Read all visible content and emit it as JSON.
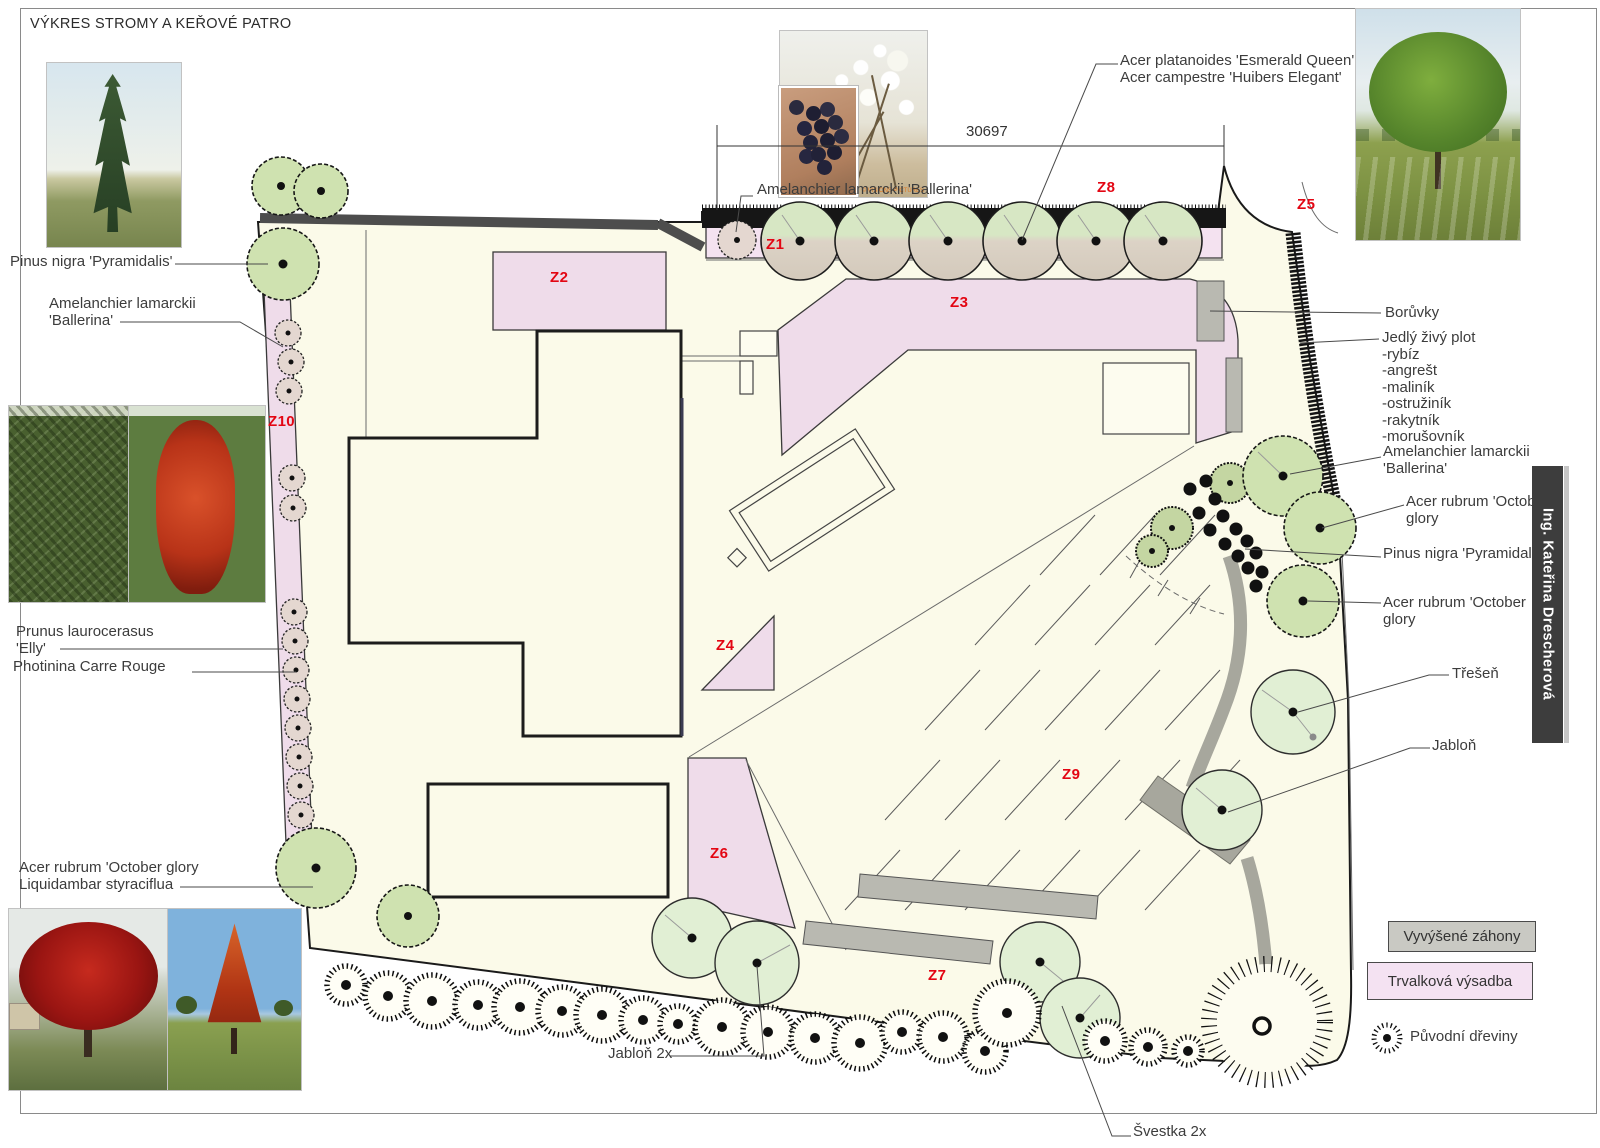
{
  "title": "VÝKRES STROMY A KEŘOVÉ PATRO",
  "author_bar": "Ing. Kateřina Drescherová",
  "dimension": {
    "value": "30697"
  },
  "zones": {
    "z1": "Z1",
    "z2": "Z2",
    "z3": "Z3",
    "z4": "Z4",
    "z5": "Z5",
    "z6": "Z6",
    "z7": "Z7",
    "z8": "Z8",
    "z9": "Z9",
    "z10": "Z10"
  },
  "labels": {
    "pinus_left": "Pinus nigra 'Pyramidalis'",
    "amelanchier_left": "Amelanchier lamarckii\n'Ballerina'",
    "prunus_elly": "Prunus laurocerasus\n'Elly'",
    "photinia": "Photinina Carre Rouge",
    "acer_liquidambar": "Acer rubrum 'October glory\nLiquidambar styraciflua",
    "acer_platanoides": "Acer platanoides 'Esmerald Queen'\nAcer campestre 'Huibers Elegant'",
    "amelanchier_center": "Amelanchier lamarckii 'Ballerina'",
    "boruvky": "Borůvky",
    "jedly_plot": "Jedlý živý plot\n-rybíz\n-angrešt\n-maliník\n-ostružiník\n-rakytník\n-morušovník",
    "amelanchier_right": "Amelanchier lamarckii\n'Ballerina'",
    "acer_october_1": "Acer rubrum 'October\nglory",
    "pinus_right": "Pinus nigra 'Pyramidalis'",
    "acer_october_2": "Acer rubrum 'October\nglory",
    "tresen": "Třešeň",
    "jablon": "Jabloň",
    "jablon_2x": "Jabloň 2x",
    "svestka_2x": "Švestka 2x"
  },
  "legend": {
    "raised_beds": "Vyvýšené záhony",
    "perennials": "Trvalková výsadba",
    "original_trees": "Původní dřeviny"
  },
  "photos": {
    "watermark": "© VISIONS PICTURES"
  },
  "colors": {
    "zone_label": "#e30613",
    "perennial_pink": "#efdcea",
    "raised_bed_gray": "#b9b9b1",
    "plan_cream": "#fbfae9",
    "new_tree_green": "#cfe2b0",
    "fruit_tree_green": "#e1efd4",
    "wall_gray": "#4d4d4d",
    "sidebar_dark": "#3d3d3d"
  }
}
